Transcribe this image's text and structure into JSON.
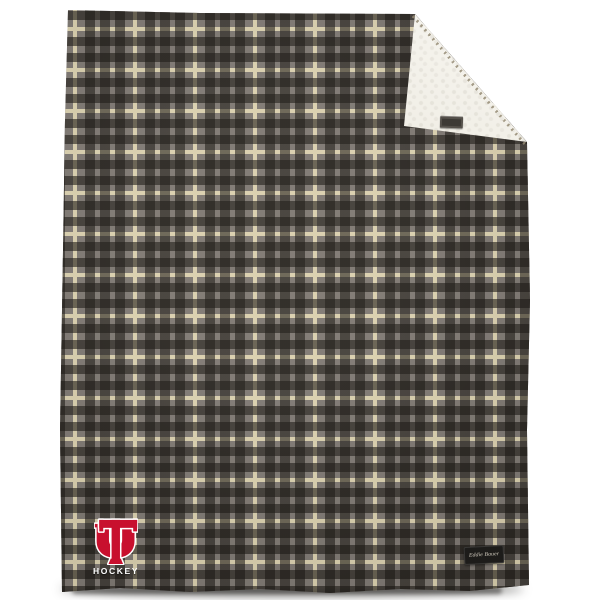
{
  "scene": {
    "background_color": "#ffffff",
    "description": "Gray plaid flannel blanket, top-right corner folded to show cream sherpa lining"
  },
  "blanket": {
    "plaid_colors": {
      "base": "#7d7771",
      "dark_band": "#24201b",
      "cream_stripe": "#d9cfad"
    },
    "sherpa_color": "#eae6d8",
    "logo": {
      "monogram": "UT",
      "monogram_color": "#c8102e",
      "monogram_outline": "#ffffff",
      "word": "HOCKEY",
      "word_color": "#ffffff"
    },
    "brand_tag": {
      "text": "Eddie Bauer",
      "bg": "#1d1c1a",
      "text_color": "#cfc9bc"
    },
    "corner_tag": {
      "text": "",
      "bg": "#55514b"
    }
  }
}
